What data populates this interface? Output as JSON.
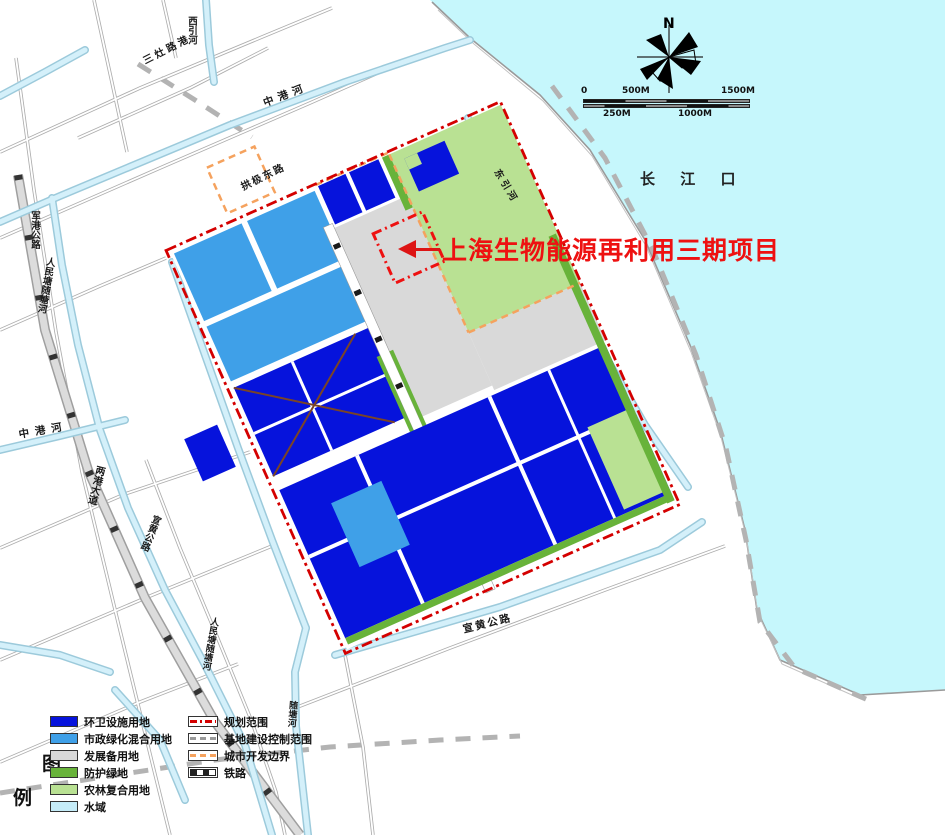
{
  "annotation": {
    "text": "上海生物能源再利用三期项目"
  },
  "water": {
    "label": "长 江 口"
  },
  "compass": {
    "label": "N"
  },
  "scalebar": {
    "ticks_top": [
      "0",
      "500M",
      "1500M"
    ],
    "ticks_bottom": [
      "250M",
      "1000M"
    ]
  },
  "map_labels": [
    {
      "name": "river-xiyinhe",
      "text": "西引河"
    },
    {
      "name": "road-sanzaolugang",
      "text": "三灶路港"
    },
    {
      "name": "river-zhonggang-top",
      "text": "中港河"
    },
    {
      "name": "road-gongji-east",
      "text": "拱极东路"
    },
    {
      "name": "river-dongyinhe",
      "text": "东引河"
    },
    {
      "name": "road-jungang",
      "text": "军港公路"
    },
    {
      "name": "river-renmintang-1",
      "text": "人民塘随塘河"
    },
    {
      "name": "river-zhonggang-west",
      "text": "中港河"
    },
    {
      "name": "road-lianggang",
      "text": "两港大道"
    },
    {
      "name": "road-xuanhuang-west",
      "text": "宣黄公路"
    },
    {
      "name": "river-renmintang-2",
      "text": "人民塘随塘河"
    },
    {
      "name": "river-suitanghe",
      "text": "随塘河"
    },
    {
      "name": "road-xuanhuang-south",
      "text": "宣黄公路"
    }
  ],
  "legend": {
    "title_top": "图",
    "title_bottom": "例",
    "area_items": [
      {
        "label": "环卫设施用地",
        "color": "#0613dc"
      },
      {
        "label": "市政绿化混合用地",
        "color": "#3fa0e8"
      },
      {
        "label": "发展备用地",
        "color": "#d9d9d9"
      },
      {
        "label": "防护绿地",
        "color": "#68b33a"
      },
      {
        "label": "农林复合用地",
        "color": "#b9e193"
      },
      {
        "label": "水域",
        "color": "#c5ecf8"
      }
    ],
    "line_items": [
      {
        "label": "规划范围"
      },
      {
        "label": "基地建设控制范围"
      },
      {
        "label": "城市开发边界"
      },
      {
        "label": "铁路"
      }
    ]
  },
  "colors": {
    "sanitation_blue": "#0613dc",
    "municipal_blue": "#3fa0e8",
    "reserve_gray": "#d9d9d9",
    "protect_green": "#68b33a",
    "agri_green": "#b9e193",
    "water_cyan": "#c6f7fc",
    "boundary_red": "#d40000",
    "city_boundary_orange": "#f5a25e",
    "annotation_red": "#ee1111"
  }
}
